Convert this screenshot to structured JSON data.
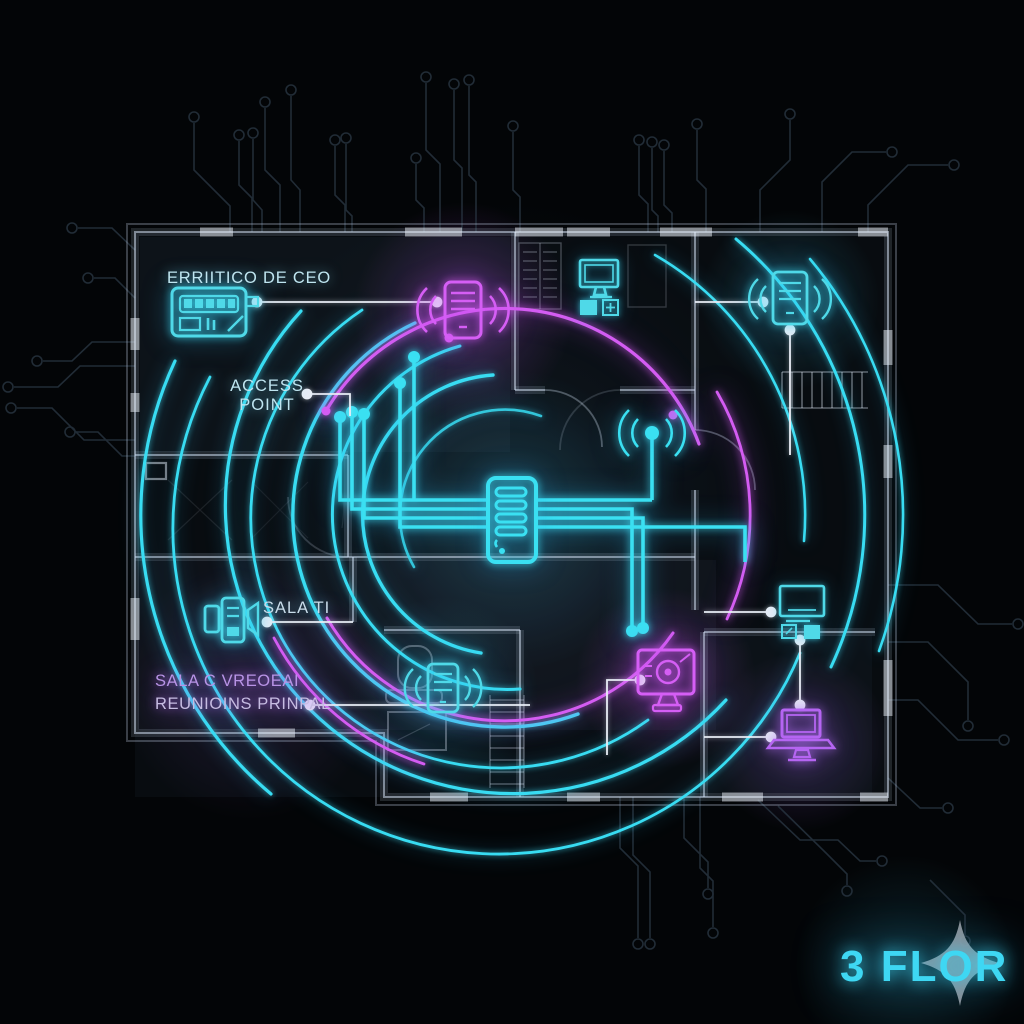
{
  "title": "3 FLOR network floor plan",
  "colors": {
    "background": "#030507",
    "neon_cyan": "#38dcf2",
    "neon_magenta": "#d45cf2",
    "neon_purple": "#b565f0",
    "wall": "#aebcd0",
    "leader_white": "#e9eef6",
    "label_cyan": "#bfe5f0",
    "label_purple": "#b995e6",
    "label_lavender": "#c6bce2",
    "logo_cyan": "#3ed7f3",
    "logo_star_gray": "#97999f"
  },
  "labels": {
    "ceo_office": "ERRIITICO DE CEO",
    "access_point_line1": "ACCESS",
    "access_point_line2": "POINT",
    "sala_ti": "SALA TI",
    "meeting_room_line1": "SALA C VREOEAI",
    "meeting_room_line2": "REUNIOINS PRINPAL",
    "logo": "3 FLOR"
  },
  "devices": [
    {
      "name": "network-switch-icon",
      "area": "ceo-office",
      "color": "cyan"
    },
    {
      "name": "wireless-access-point-icon",
      "area": "top-center",
      "color": "magenta"
    },
    {
      "name": "wireless-access-point-icon",
      "area": "top-right-room",
      "color": "cyan"
    },
    {
      "name": "desktop-computer-icon",
      "area": "top-middle-room",
      "color": "cyan"
    },
    {
      "name": "rack-server-icon",
      "area": "center",
      "color": "cyan"
    },
    {
      "name": "antenna-access-point-icon",
      "area": "center-right",
      "color": "cyan"
    },
    {
      "name": "intercom-device-icon",
      "area": "sala-ti",
      "color": "cyan"
    },
    {
      "name": "wireless-access-point-icon",
      "area": "bottom-center-room",
      "color": "cyan"
    },
    {
      "name": "security-monitor-icon",
      "area": "bottom-center-right",
      "color": "magenta"
    },
    {
      "name": "desktop-monitor-icon",
      "area": "right-room",
      "color": "cyan"
    },
    {
      "name": "laptop-icon",
      "area": "bottom-right-room",
      "color": "purple"
    }
  ]
}
